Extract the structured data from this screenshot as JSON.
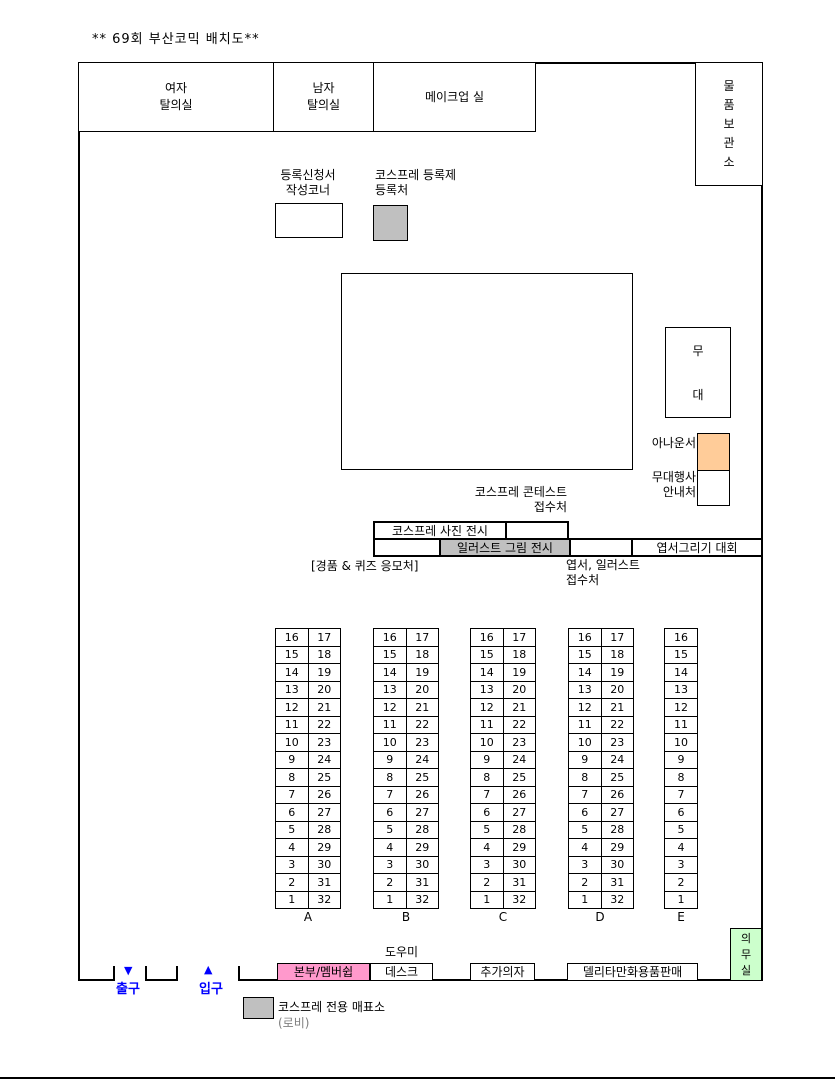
{
  "title": "**  69회 부산코믹 배치도**",
  "colors": {
    "gray": "#C0C0C0",
    "orange": "#FFCC99",
    "pink": "#FF99CC",
    "green": "#CCFFCC",
    "blue": "#0000FF",
    "line": "#000000"
  },
  "top_rooms": {
    "women": "여자\n탈의실",
    "men": "남자\n탈의실",
    "makeup": "메이크업 실",
    "storage": "물품보관소"
  },
  "registration": {
    "form_corner": "등록신청서\n작성코너",
    "cosplay_registration": "코스프레 등록제\n등록처"
  },
  "stage": {
    "stage": "무대",
    "announcer": "아나운서",
    "event_info": "무대행사\n안내처"
  },
  "exhibits": {
    "contest_reception": "코스프레 콘테스트\n접수처",
    "photo_exhibit": "코스프레 사진 전시",
    "illust_exhibit": "일러스트 그림 전시",
    "postcard_contest": "엽서그리기 대회",
    "prize_quiz": "[경품 & 퀴즈 응모처]",
    "postcard_illust_reception": "엽서, 일러스트\n접수처"
  },
  "tables": {
    "labels": [
      "A",
      "B",
      "C",
      "D",
      "E"
    ],
    "left_numbers": [
      16,
      15,
      14,
      13,
      12,
      11,
      10,
      9,
      8,
      7,
      6,
      5,
      4,
      3,
      2,
      1
    ],
    "right_numbers": [
      17,
      18,
      19,
      20,
      21,
      22,
      23,
      24,
      25,
      26,
      27,
      28,
      29,
      30,
      31,
      32
    ]
  },
  "bottom": {
    "exit_arrow": "▼",
    "exit": "출구",
    "entrance_arrow": "▲",
    "entrance": "입구",
    "hq_membership": "본부/멤버쉽",
    "helper": "도우미",
    "desk": "데스크",
    "extra_chairs": "추가의자",
    "delita_sales": "델리타만화용품판매",
    "infirmary": "의무실",
    "cosplay_ticket_booth": "코스프레 전용 매표소",
    "lobby": "(로비)"
  }
}
